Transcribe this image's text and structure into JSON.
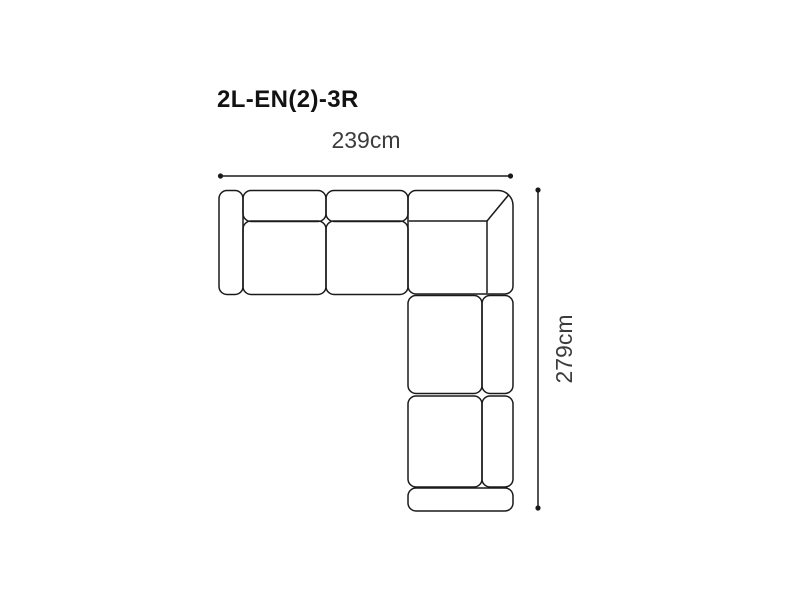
{
  "page": {
    "background": "#ffffff"
  },
  "diagram": {
    "title": "2L-EN(2)-3R",
    "width_dimension": "239cm",
    "height_dimension": "279cm",
    "line_color": "#1a1a1a",
    "title_color": "#121212",
    "label_color": "#3c3c3c",
    "drawing_description": "Top view outline of an L-shaped corner sofa: left armrest, two seats with back cushions on top run, corner unit with diagonal seam, two seats with back cushions on right-hand downward run, bottom armrest",
    "parts": [
      "left-armrest",
      "back-cushion-1",
      "seat-cushion-1",
      "back-cushion-2",
      "seat-cushion-2",
      "corner-unit",
      "seat-cushion-3",
      "back-cushion-3",
      "seat-cushion-4",
      "back-cushion-4",
      "bottom-armrest"
    ]
  }
}
